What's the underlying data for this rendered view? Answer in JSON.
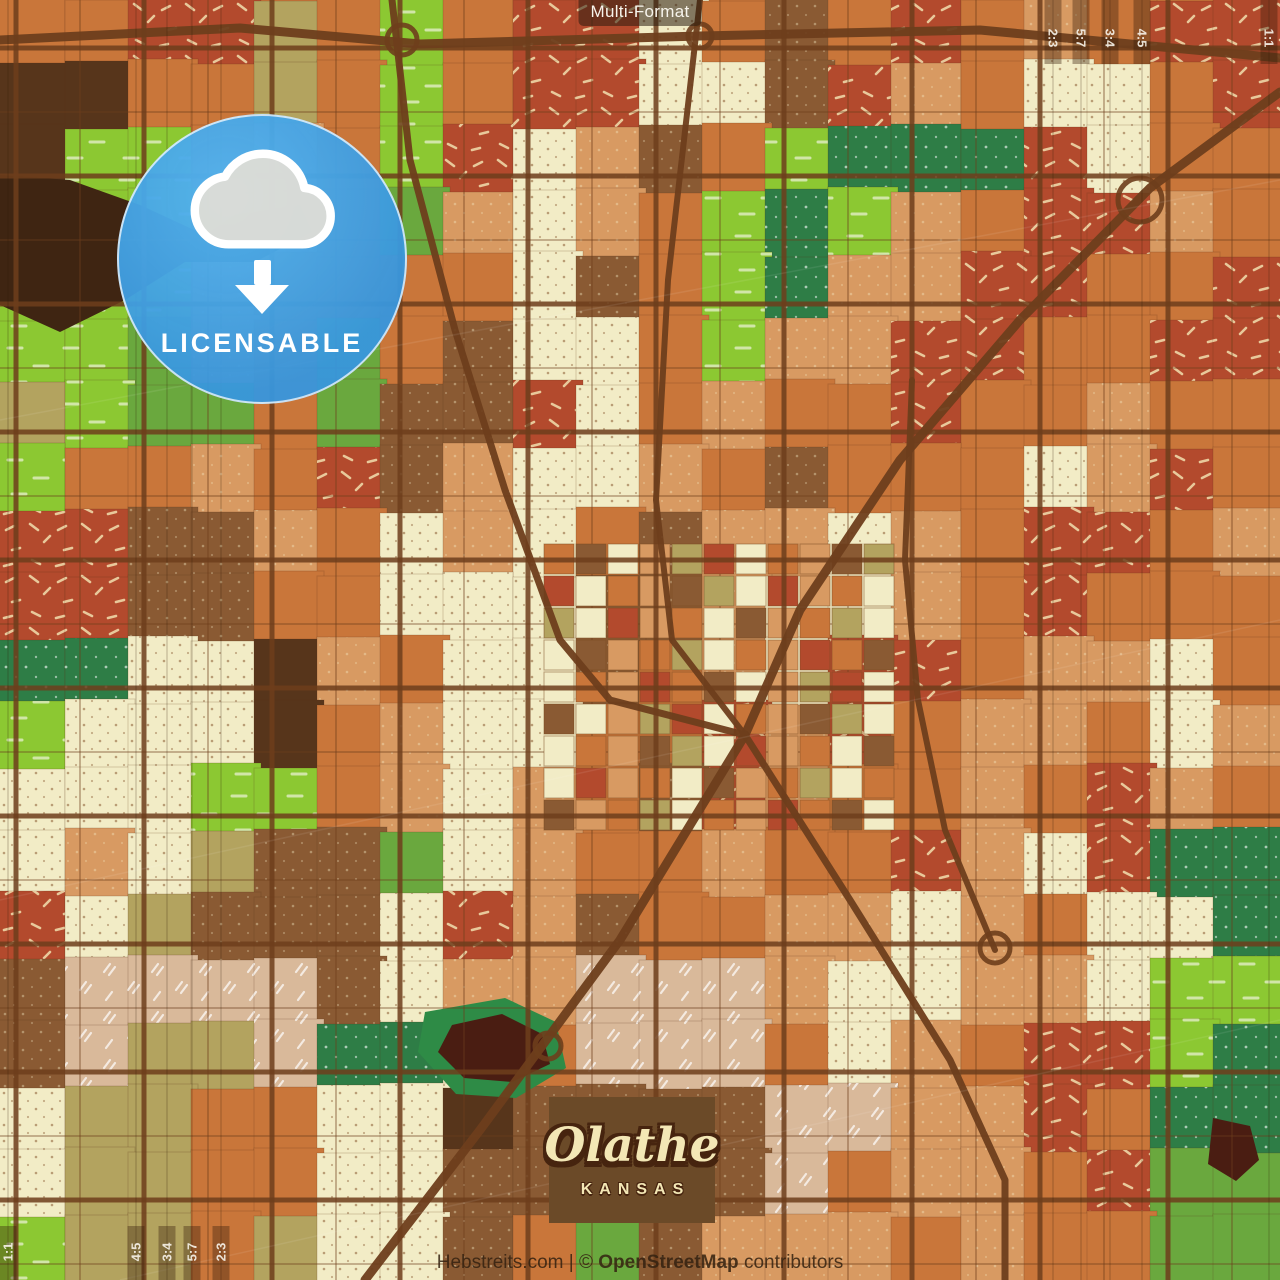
{
  "header": {
    "format_label": "Multi-Format"
  },
  "badge": {
    "label": "LICENSABLE",
    "circle_color": "#3fa0e4",
    "icon": "cloud-download"
  },
  "title_card": {
    "city": "Olathe",
    "state": "KANSAS",
    "bg": "#6b4a28",
    "text_color": "#f3e7b5"
  },
  "attribution": {
    "site": "Hebstreits.com",
    "separator": " | ",
    "copyright_prefix": "© ",
    "osm": "OpenStreetMap",
    "suffix": " contributors"
  },
  "crop_guides": {
    "strip_color": "rgba(55,30,10,0.38)",
    "line_color": "rgba(50,25,8,0.15)",
    "label_color": "#f5f0e6",
    "top_right": [
      {
        "label": "2:3",
        "x": 1053
      },
      {
        "label": "5:7",
        "x": 1081
      },
      {
        "label": "3:4",
        "x": 1110
      },
      {
        "label": "4:5",
        "x": 1142
      },
      {
        "label": "1:1",
        "x": 1269
      }
    ],
    "bottom_left": [
      {
        "label": "1:1",
        "x": 8
      },
      {
        "label": "4:5",
        "x": 136
      },
      {
        "label": "3:4",
        "x": 167
      },
      {
        "label": "5:7",
        "x": 192
      },
      {
        "label": "2:3",
        "x": 221
      }
    ]
  },
  "map": {
    "cell_size": 64,
    "palette": [
      "#c9763a",
      "#b34a2d",
      "#8cc832",
      "#6aa83e",
      "#f2ecc6",
      "#b3a35f",
      "#8a5a33",
      "#57351b",
      "#d89a62",
      "#2e7d46",
      "#d9b99a"
    ],
    "textures": {
      "1": "p-dash",
      "2": "p-meadow",
      "4": "p-dots-dark",
      "6": "p-dots-light",
      "8": "p-dots-light",
      "9": "p-dots-white",
      "10": "p-ticks-white"
    },
    "grid": [
      [
        0,
        0,
        1,
        1,
        5,
        0,
        2,
        0,
        1,
        1,
        4,
        0,
        6,
        0,
        1,
        0,
        8,
        0,
        1,
        1
      ],
      [
        7,
        7,
        0,
        0,
        5,
        0,
        2,
        0,
        1,
        1,
        4,
        4,
        6,
        1,
        8,
        0,
        4,
        4,
        0,
        1
      ],
      [
        7,
        2,
        2,
        0,
        8,
        0,
        2,
        1,
        4,
        8,
        6,
        0,
        2,
        9,
        9,
        9,
        1,
        4,
        0,
        0
      ],
      [
        2,
        2,
        2,
        0,
        8,
        0,
        3,
        8,
        4,
        8,
        0,
        2,
        9,
        2,
        8,
        0,
        1,
        1,
        8,
        0
      ],
      [
        2,
        2,
        2,
        8,
        0,
        0,
        0,
        0,
        4,
        6,
        0,
        2,
        9,
        8,
        8,
        1,
        1,
        0,
        0,
        1
      ],
      [
        2,
        2,
        3,
        8,
        0,
        3,
        0,
        6,
        4,
        4,
        0,
        2,
        8,
        8,
        1,
        1,
        0,
        0,
        1,
        1
      ],
      [
        5,
        2,
        3,
        3,
        0,
        3,
        6,
        6,
        1,
        4,
        0,
        8,
        0,
        0,
        1,
        0,
        0,
        8,
        0,
        0
      ],
      [
        2,
        0,
        0,
        8,
        0,
        1,
        6,
        8,
        4,
        4,
        8,
        0,
        6,
        0,
        0,
        0,
        4,
        8,
        1,
        0
      ],
      [
        1,
        1,
        6,
        6,
        8,
        0,
        4,
        8,
        4,
        0,
        6,
        8,
        8,
        4,
        8,
        0,
        1,
        1,
        0,
        8
      ],
      [
        1,
        1,
        6,
        6,
        0,
        0,
        4,
        4,
        4,
        6,
        6,
        8,
        4,
        4,
        8,
        0,
        1,
        0,
        0,
        0
      ],
      [
        9,
        9,
        4,
        4,
        7,
        8,
        0,
        4,
        4,
        6,
        0,
        8,
        4,
        1,
        1,
        0,
        8,
        8,
        4,
        0
      ],
      [
        2,
        4,
        4,
        4,
        7,
        0,
        8,
        4,
        4,
        0,
        0,
        1,
        8,
        1,
        0,
        8,
        8,
        0,
        4,
        8
      ],
      [
        4,
        4,
        4,
        2,
        2,
        0,
        8,
        4,
        8,
        0,
        6,
        1,
        8,
        0,
        0,
        8,
        0,
        1,
        8,
        0
      ],
      [
        4,
        8,
        4,
        5,
        6,
        6,
        3,
        4,
        8,
        0,
        0,
        8,
        0,
        0,
        1,
        8,
        4,
        1,
        9,
        9
      ],
      [
        1,
        4,
        5,
        6,
        6,
        6,
        4,
        1,
        8,
        6,
        0,
        0,
        8,
        8,
        4,
        8,
        0,
        4,
        4,
        9
      ],
      [
        6,
        10,
        10,
        10,
        10,
        6,
        4,
        8,
        8,
        10,
        10,
        10,
        8,
        4,
        4,
        8,
        8,
        4,
        2,
        2
      ],
      [
        6,
        10,
        5,
        5,
        10,
        9,
        9,
        4,
        0,
        10,
        10,
        10,
        0,
        4,
        8,
        0,
        1,
        1,
        2,
        9
      ],
      [
        4,
        5,
        5,
        0,
        0,
        4,
        4,
        7,
        6,
        6,
        6,
        6,
        10,
        10,
        8,
        8,
        1,
        0,
        9,
        9
      ],
      [
        4,
        5,
        5,
        0,
        0,
        4,
        4,
        6,
        6,
        6,
        6,
        6,
        10,
        0,
        8,
        8,
        0,
        1,
        3,
        3
      ],
      [
        2,
        5,
        5,
        0,
        5,
        4,
        4,
        6,
        0,
        3,
        6,
        8,
        8,
        8,
        0,
        8,
        0,
        0,
        3,
        3
      ]
    ],
    "downtown": {
      "x": 544,
      "y": 544,
      "cols": 11,
      "rows": 9,
      "cell": 32,
      "seq": [
        0,
        6,
        4,
        8,
        5,
        1,
        4,
        0,
        8,
        6,
        5,
        4,
        1,
        8,
        0,
        4,
        6,
        8,
        0,
        5,
        4,
        0,
        8,
        1
      ]
    },
    "features": [
      {
        "name": "river-blob-nw",
        "color": "#3f2512",
        "points": [
          [
            0,
            175
          ],
          [
            70,
            180
          ],
          [
            140,
            205
          ],
          [
            205,
            235
          ],
          [
            235,
            215
          ],
          [
            300,
            205
          ],
          [
            312,
            232
          ],
          [
            255,
            262
          ],
          [
            185,
            262
          ],
          [
            125,
            300
          ],
          [
            60,
            332
          ],
          [
            0,
            305
          ]
        ]
      },
      {
        "name": "pond-ring-south",
        "color": "#2e8b46",
        "points": [
          [
            425,
            1012
          ],
          [
            505,
            998
          ],
          [
            556,
            1022
          ],
          [
            566,
            1068
          ],
          [
            516,
            1098
          ],
          [
            456,
            1094
          ],
          [
            418,
            1052
          ]
        ]
      },
      {
        "name": "pond-south",
        "color": "#4a1d12",
        "points": [
          [
            452,
            1025
          ],
          [
            502,
            1014
          ],
          [
            542,
            1034
          ],
          [
            550,
            1064
          ],
          [
            512,
            1082
          ],
          [
            464,
            1078
          ],
          [
            438,
            1052
          ]
        ]
      },
      {
        "name": "pond-southeast",
        "color": "#4a1d12",
        "points": [
          [
            1213,
            1118
          ],
          [
            1250,
            1126
          ],
          [
            1259,
            1160
          ],
          [
            1236,
            1181
          ],
          [
            1208,
            1164
          ]
        ]
      }
    ],
    "roads": {
      "color": "#6e3e1c",
      "grid_major": {
        "v_offset": 16,
        "h_offset": 48,
        "every": 128,
        "width": 5,
        "opacity": 0.85
      },
      "grid_minor": {
        "v_offset": 80,
        "h_offset": 112,
        "every": 128,
        "width": 1.8,
        "opacity": 0.4
      },
      "diagonals": [
        {
          "name": "highway-top",
          "width": 9,
          "points": [
            [
              0,
              40
            ],
            [
              240,
              28
            ],
            [
              420,
              44
            ],
            [
              700,
              36
            ],
            [
              980,
              30
            ],
            [
              1280,
              58
            ]
          ]
        },
        {
          "name": "highway-northeast",
          "width": 9,
          "points": [
            [
              1280,
              92
            ],
            [
              1150,
              188
            ],
            [
              1020,
              320
            ],
            [
              900,
              460
            ],
            [
              800,
              610
            ],
            [
              745,
              735
            ]
          ]
        },
        {
          "name": "rail-north",
          "width": 6,
          "points": [
            [
              700,
              0
            ],
            [
              668,
              280
            ],
            [
              656,
              500
            ],
            [
              672,
              640
            ],
            [
              745,
              735
            ]
          ]
        },
        {
          "name": "highway-southwest",
          "width": 9,
          "points": [
            [
              745,
              735
            ],
            [
              620,
              940
            ],
            [
              480,
              1130
            ],
            [
              365,
              1280
            ]
          ]
        },
        {
          "name": "highway-southeast",
          "width": 7,
          "points": [
            [
              745,
              735
            ],
            [
              850,
              900
            ],
            [
              950,
              1060
            ],
            [
              1005,
              1180
            ],
            [
              1005,
              1280
            ]
          ]
        },
        {
          "name": "road-northwest",
          "width": 7,
          "points": [
            [
              392,
              0
            ],
            [
              410,
              160
            ],
            [
              455,
              330
            ],
            [
              505,
              490
            ],
            [
              560,
              640
            ],
            [
              610,
              700
            ],
            [
              745,
              735
            ]
          ]
        },
        {
          "name": "road-ns-east",
          "width": 6,
          "points": [
            [
              912,
              380
            ],
            [
              905,
              560
            ],
            [
              918,
              700
            ],
            [
              945,
              830
            ],
            [
              995,
              950
            ]
          ]
        }
      ],
      "interchanges": [
        {
          "x": 1140,
          "y": 200,
          "r": 22
        },
        {
          "x": 402,
          "y": 40,
          "r": 15
        },
        {
          "x": 700,
          "y": 36,
          "r": 12
        },
        {
          "x": 548,
          "y": 1046,
          "r": 13
        },
        {
          "x": 995,
          "y": 948,
          "r": 15
        }
      ]
    },
    "scratches": [
      [
        [
          0,
          420
        ],
        [
          1280,
          180
        ]
      ],
      [
        [
          0,
          900
        ],
        [
          1280,
          620
        ]
      ],
      [
        [
          120,
          1280
        ],
        [
          1280,
          1020
        ]
      ]
    ]
  }
}
